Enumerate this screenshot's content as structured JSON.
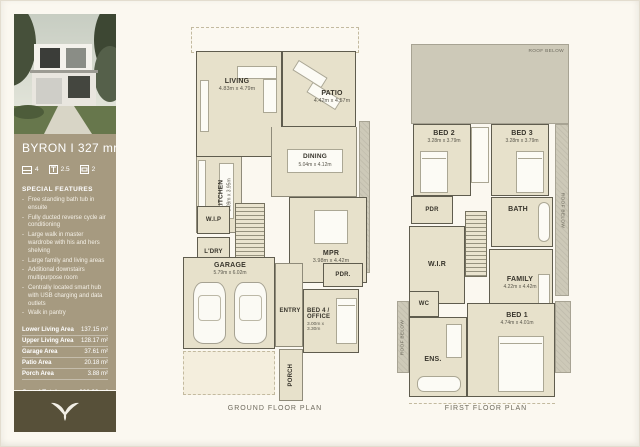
{
  "sidebar": {
    "title": "BYRON I 327 mr",
    "stats": {
      "beds": "4",
      "baths": "2.5",
      "cars": "2"
    },
    "features_heading": "SPECIAL FEATURES",
    "features": [
      "Free standing bath tub in ensuite",
      "Fully ducted reverse cycle air conditioning",
      "Large walk in master wardrobe with his and hers shelving",
      "Large family and living areas",
      "Additional downstairs multipurpose room",
      "Centrally located smart hub with USB charging and data outlets",
      "Walk in pantry"
    ],
    "areas": [
      {
        "label": "Lower Living Area",
        "value": "137.15 m²"
      },
      {
        "label": "Upper Living Area",
        "value": "128.17 m²"
      },
      {
        "label": "Garage Area",
        "value": "37.61 m²"
      },
      {
        "label": "Patio Area",
        "value": "20.18 m²"
      },
      {
        "label": "Porch Area",
        "value": "3.88 m²"
      }
    ],
    "grand_total": {
      "label": "Grand Total",
      "value": "326.99 m²"
    }
  },
  "ground_floor": {
    "caption": "GROUND FLOOR PLAN",
    "rooms": {
      "living": {
        "name": "LIVING",
        "dims": "4.83m x 4.79m"
      },
      "patio": {
        "name": "PATIO",
        "dims": "4.42m x 4.57m"
      },
      "kitchen": {
        "name": "KITCHEN",
        "dims": "3.09m x 3.95m"
      },
      "dining": {
        "name": "DINING",
        "dims": "5.04m x 4.12m"
      },
      "wip": {
        "name": "W.I.P"
      },
      "ldry": {
        "name": "L'DRY"
      },
      "mpr": {
        "name": "MPR",
        "dims": "3.98m x 4.42m"
      },
      "garage": {
        "name": "GARAGE",
        "dims": "5.79m x 6.02m"
      },
      "entry": {
        "name": "ENTRY"
      },
      "pdr": {
        "name": "PDR."
      },
      "bed4": {
        "name": "BED 4 / OFFICE",
        "dims": "3.00m x 3.30m"
      },
      "porch": {
        "name": "PORCH"
      }
    }
  },
  "first_floor": {
    "caption": "FIRST FLOOR PLAN",
    "roof_below_label": "ROOF BELOW",
    "rooms": {
      "bed2": {
        "name": "BED 2",
        "dims": "3.28m x 3.79m"
      },
      "bed3": {
        "name": "BED 3",
        "dims": "3.28m x 3.79m"
      },
      "pdr": {
        "name": "PDR"
      },
      "bath": {
        "name": "BATH"
      },
      "wir": {
        "name": "W.I.R"
      },
      "family": {
        "name": "FAMILY",
        "dims": "4.22m x 4.42m"
      },
      "wc": {
        "name": "WC"
      },
      "ens": {
        "name": "ENS."
      },
      "bed1": {
        "name": "BED 1",
        "dims": "4.74m x 4.01m"
      }
    }
  },
  "colors": {
    "panel": "#a69a80",
    "footer": "#575039",
    "room_fill": "#e7e1cb",
    "roof_fill": "#cdc9b8",
    "page_bg": "#fbf8f0"
  }
}
